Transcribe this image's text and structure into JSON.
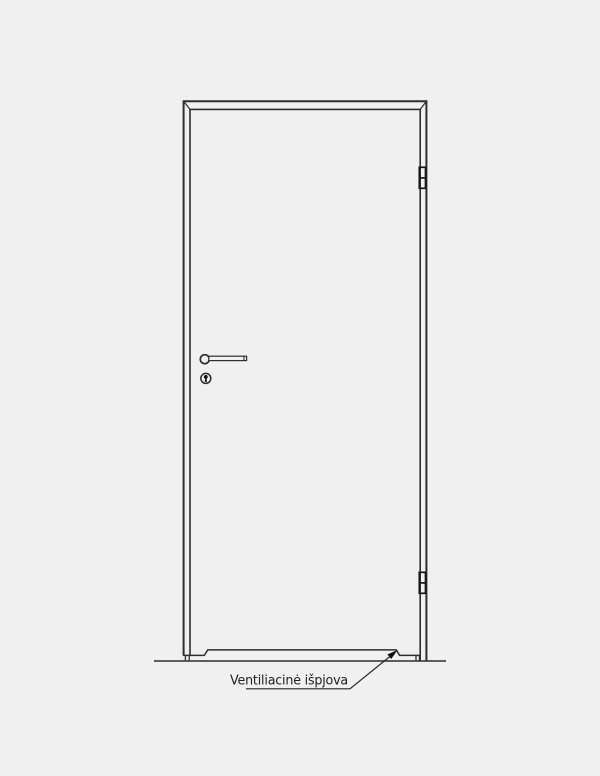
{
  "drawing": {
    "title": "door-technical-drawing",
    "annotation": {
      "label": "Ventiliacinė išpjova"
    },
    "parts": [
      "door-frame",
      "door-leaf",
      "top-hinge",
      "bottom-hinge",
      "lever-handle",
      "keyhole",
      "ventilation-cutout",
      "floor-line",
      "leader-arrow"
    ]
  },
  "colors": {
    "background": "#f0f0f0",
    "line": "#2e2e2e",
    "hinge": "#151515",
    "text": "#1f1f1f"
  }
}
